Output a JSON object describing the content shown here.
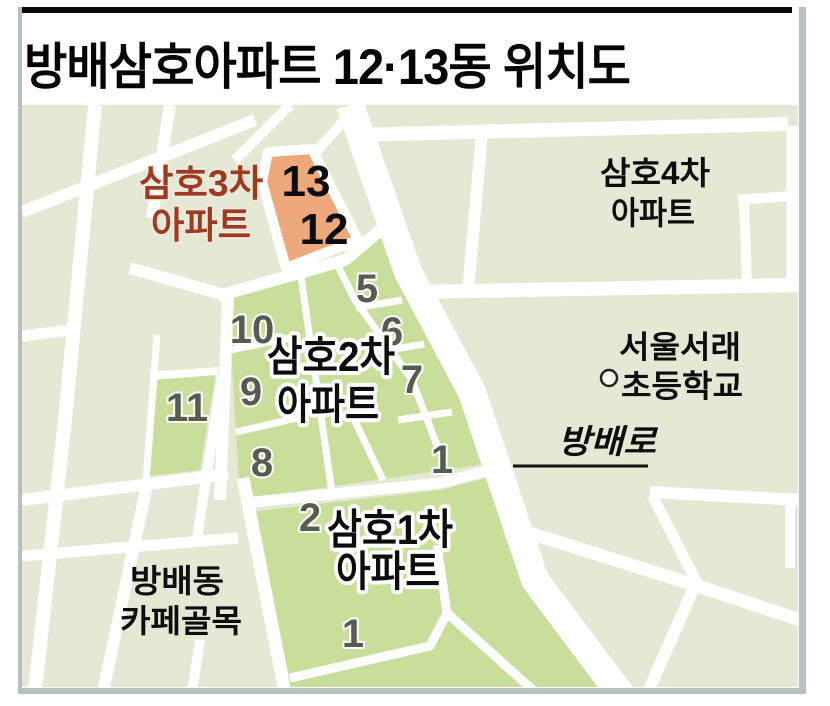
{
  "title": "방배삼호아파트 12·13동 위치도",
  "map": {
    "highlight_complex": {
      "name_line1": "삼호3차",
      "name_line2": "아파트",
      "units": {
        "u13": "13",
        "u12": "12"
      }
    },
    "complexes": {
      "samho4_line1": "삼호4차",
      "samho4_line2": "아파트",
      "samho2_line1": "삼호2차",
      "samho2_line2": "아파트",
      "samho1_line1": "삼호1차",
      "samho1_line2": "아파트"
    },
    "school": {
      "line1": "서울서래",
      "line2": "초등학교"
    },
    "road_label": "방배로",
    "district": {
      "line1": "방배동",
      "line2": "카페골목"
    },
    "unit_numbers": {
      "n5": "5",
      "n6": "6",
      "n7": "7",
      "n8": "8",
      "n9": "9",
      "n10": "10",
      "n11": "11",
      "n1_upper": "1",
      "n2": "2",
      "n1_lower": "1"
    },
    "colors": {
      "block_beige": "#e4e8d4",
      "block_green": "#cade9c",
      "block_orange": "#eda87c",
      "road_white": "#ffffff",
      "label_red": "#9e3a22",
      "number_gray": "#575c50",
      "frame_gray": "#b9bfbc",
      "title_black": "#050505"
    }
  }
}
